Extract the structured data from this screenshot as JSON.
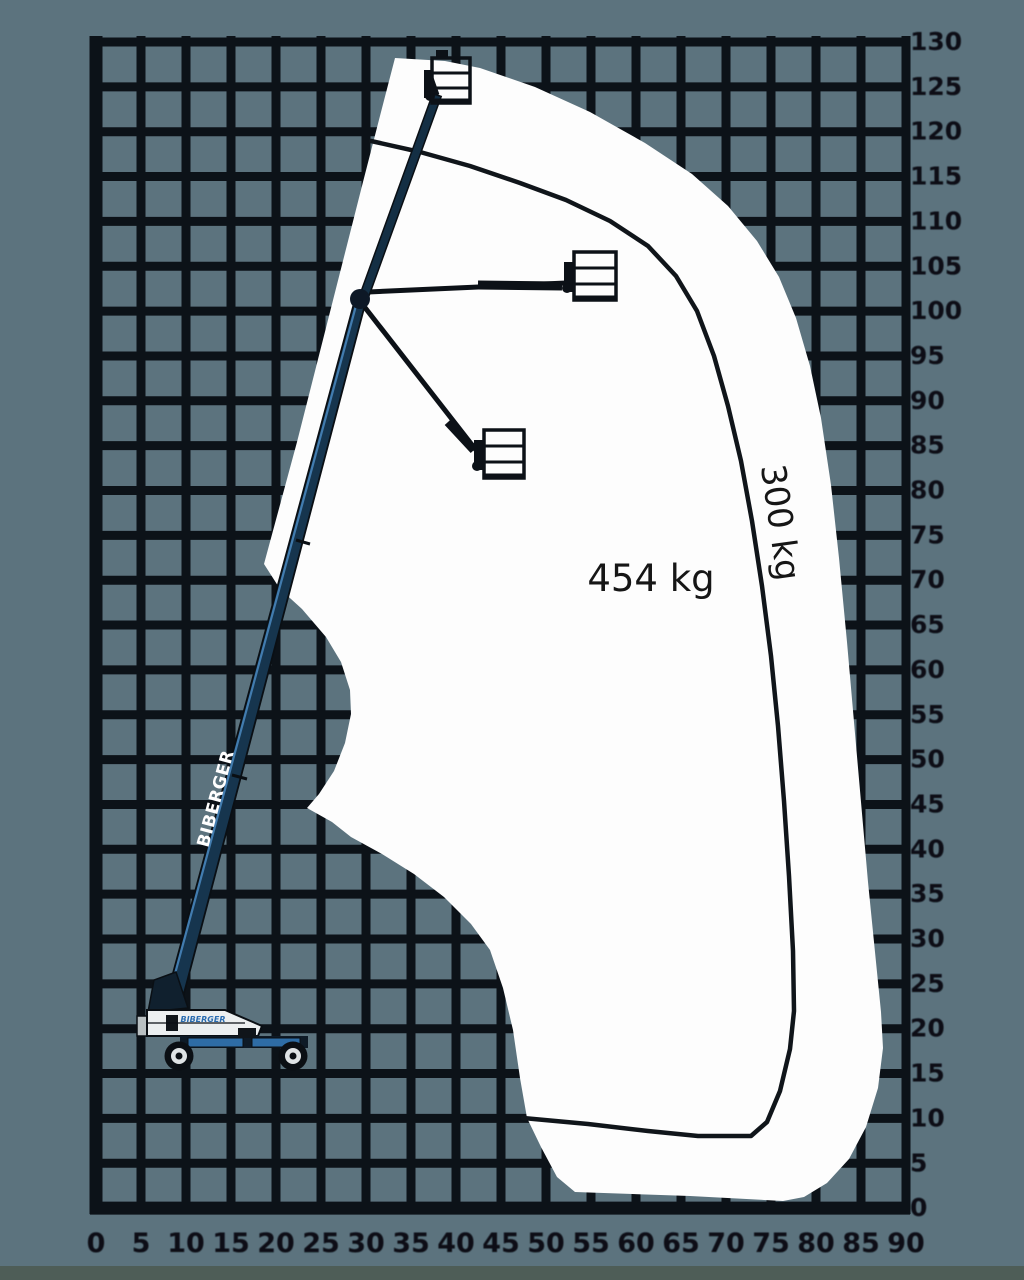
{
  "diagram": {
    "type": "boom-lift-working-range-envelope",
    "capacity_zones": {
      "inner_label": "454 kg",
      "outer_label": "300 kg"
    },
    "branding": {
      "boom_label": "BIBERGER",
      "body_logo": "BIBERGER"
    },
    "axes": {
      "x": {
        "tick_labels": [
          "0",
          "5",
          "10",
          "15",
          "20",
          "25",
          "30",
          "35",
          "40",
          "45",
          "50",
          "55",
          "60",
          "65",
          "70",
          "75",
          "80",
          "85",
          "90"
        ]
      },
      "y": {
        "tick_labels": [
          "130",
          "125",
          "120",
          "115",
          "110",
          "105",
          "100",
          "95",
          "90",
          "85",
          "80",
          "75",
          "70",
          "65",
          "60",
          "55",
          "50",
          "45",
          "40",
          "35",
          "30",
          "25",
          "20",
          "15",
          "10",
          "5",
          "0"
        ]
      }
    },
    "colors": {
      "background": "#5C737E",
      "grid_line": "#0C1218",
      "envelope_fill": "#FDFDFD",
      "zone_line": "#10151A",
      "axis_label": "#0B1016",
      "capacity_text": "#161616",
      "boom_blue": "#16354E",
      "chassis_blue": "#2E6CA5",
      "body_white": "#ECEFF0",
      "footer_strip": "#4E5D57"
    },
    "envelope": {
      "outer_boundary_points": [
        [
          395,
          58
        ],
        [
          445,
          61
        ],
        [
          480,
          68
        ],
        [
          535,
          87
        ],
        [
          590,
          112
        ],
        [
          645,
          143
        ],
        [
          692,
          174
        ],
        [
          728,
          206
        ],
        [
          757,
          241
        ],
        [
          779,
          277
        ],
        [
          796,
          318
        ],
        [
          810,
          366
        ],
        [
          821,
          418
        ],
        [
          831,
          485
        ],
        [
          839,
          558
        ],
        [
          847,
          642
        ],
        [
          854,
          722
        ],
        [
          861,
          802
        ],
        [
          868,
          882
        ],
        [
          875,
          952
        ],
        [
          881,
          1012
        ],
        [
          883,
          1048
        ],
        [
          878,
          1088
        ],
        [
          866,
          1127
        ],
        [
          849,
          1159
        ],
        [
          827,
          1183
        ],
        [
          804,
          1197
        ],
        [
          783,
          1201
        ],
        [
          690,
          1196
        ],
        [
          575,
          1192
        ],
        [
          557,
          1177
        ],
        [
          541,
          1147
        ],
        [
          527,
          1118
        ],
        [
          520,
          1078
        ],
        [
          513,
          1030
        ],
        [
          503,
          988
        ],
        [
          490,
          950
        ],
        [
          471,
          924
        ],
        [
          444,
          897
        ],
        [
          414,
          874
        ],
        [
          382,
          854
        ],
        [
          351,
          837
        ],
        [
          332,
          822
        ],
        [
          307,
          808
        ],
        [
          319,
          794
        ],
        [
          334,
          771
        ],
        [
          345,
          743
        ],
        [
          351,
          714
        ],
        [
          350,
          690
        ],
        [
          341,
          662
        ],
        [
          326,
          637
        ],
        [
          302,
          609
        ],
        [
          280,
          589
        ],
        [
          264,
          564
        ],
        [
          297,
          442
        ],
        [
          330,
          312
        ],
        [
          363,
          182
        ],
        [
          381,
          112
        ],
        [
          395,
          58
        ]
      ],
      "zone_divider_points": [
        [
          371,
          141
        ],
        [
          420,
          152
        ],
        [
          470,
          166
        ],
        [
          520,
          183
        ],
        [
          566,
          200
        ],
        [
          610,
          221
        ],
        [
          648,
          246
        ],
        [
          676,
          276
        ],
        [
          697,
          311
        ],
        [
          714,
          356
        ],
        [
          728,
          406
        ],
        [
          741,
          461
        ],
        [
          752,
          521
        ],
        [
          762,
          586
        ],
        [
          771,
          656
        ],
        [
          778,
          726
        ],
        [
          784,
          801
        ],
        [
          789,
          876
        ],
        [
          793,
          951
        ],
        [
          794,
          1011
        ],
        [
          790,
          1049
        ],
        [
          780,
          1091
        ],
        [
          767,
          1122
        ],
        [
          751,
          1136
        ],
        [
          698,
          1136
        ],
        [
          648,
          1131
        ],
        [
          588,
          1124
        ],
        [
          523,
          1118
        ]
      ]
    }
  }
}
